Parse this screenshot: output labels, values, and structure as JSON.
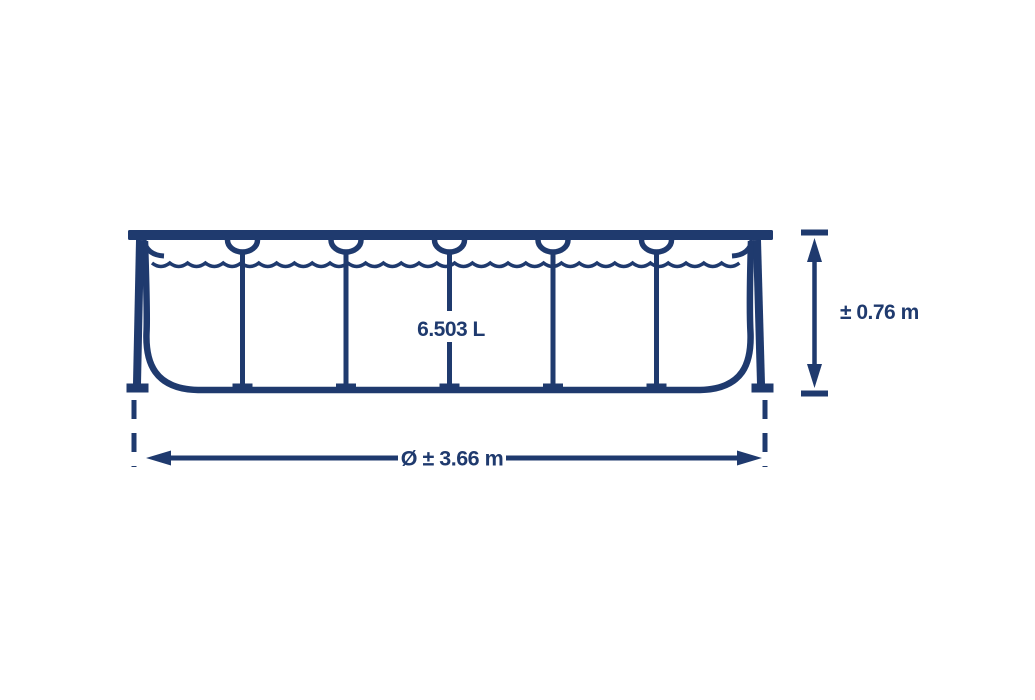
{
  "diagram": {
    "description": "Side-view dimension diagram of a round frame pool",
    "capacity_label": "6.503 L",
    "height_label": "± 0.76 m",
    "diameter_label": "Ø ± 3.66 m",
    "structure": {
      "interior_legs": 5,
      "bays": 6
    }
  },
  "colors": {
    "line": "#1f3a6e",
    "background": "#ffffff"
  }
}
